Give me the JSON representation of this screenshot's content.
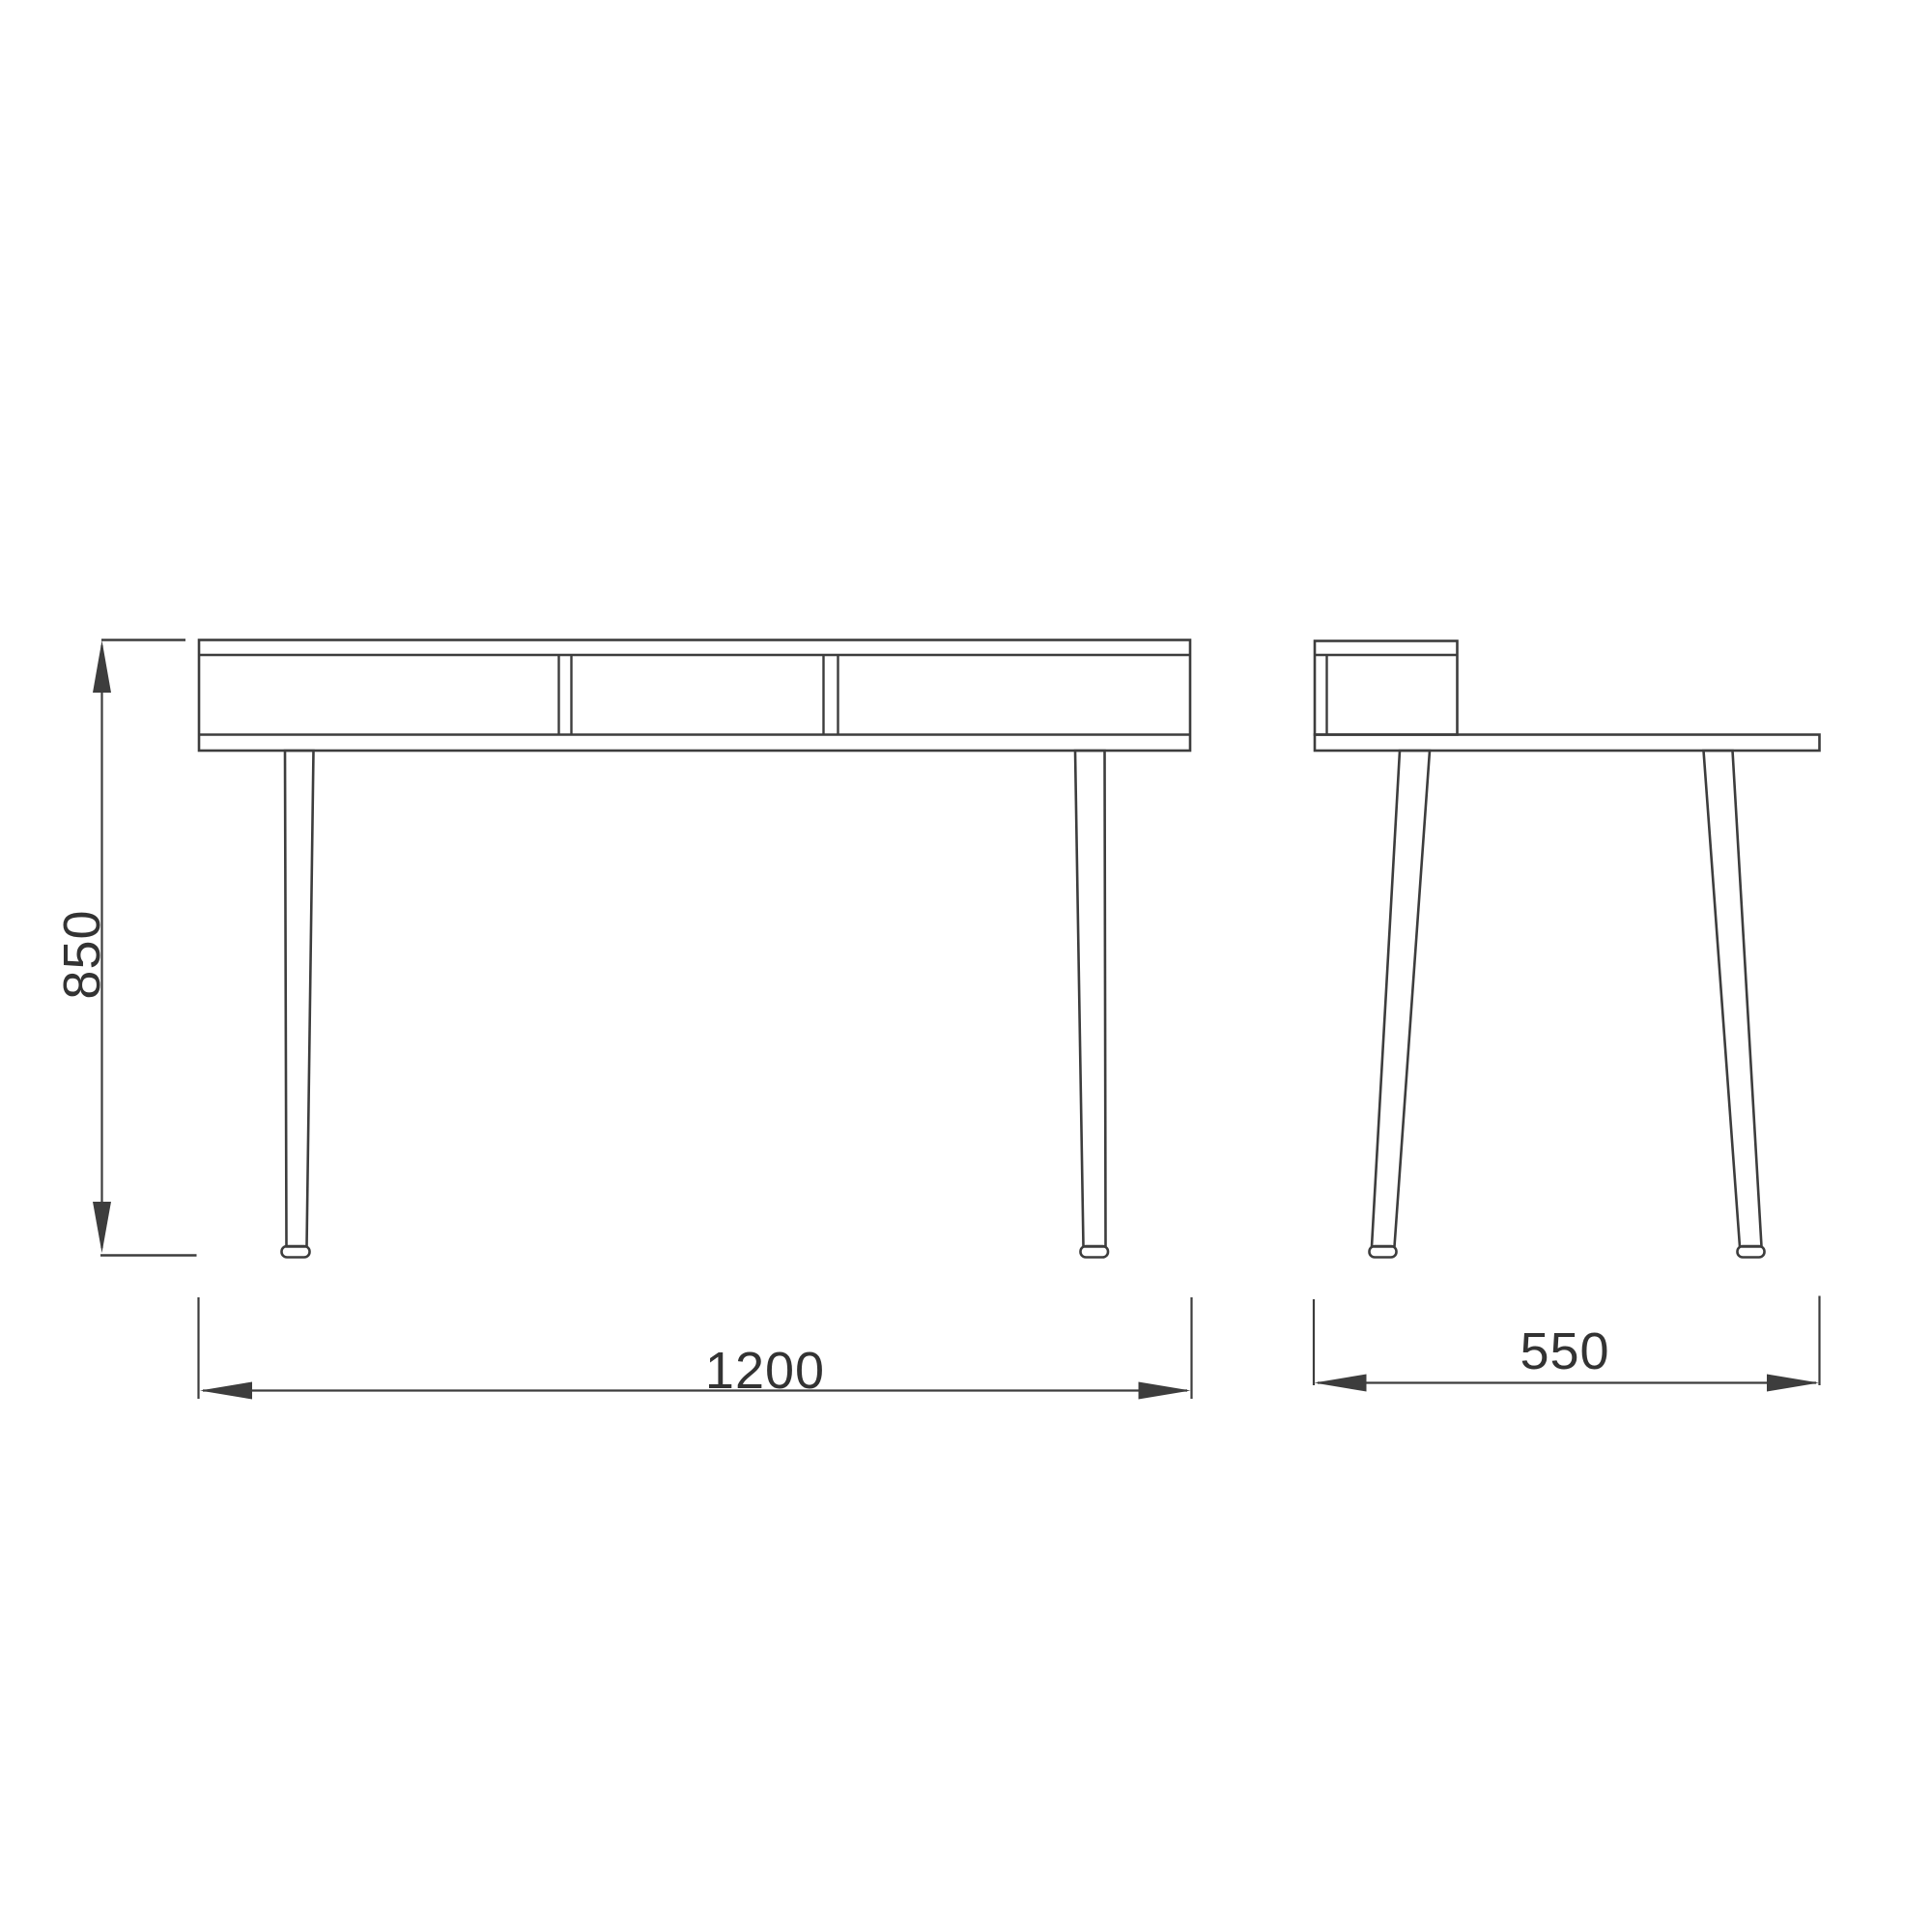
{
  "colors": {
    "background": "#ffffff",
    "line": "#3d3d3d",
    "text": "#333333"
  },
  "dimensions": {
    "height": {
      "label": "850",
      "orientation": "vertical"
    },
    "width": {
      "label": "1200",
      "orientation": "horizontal"
    },
    "depth": {
      "label": "550",
      "orientation": "horizontal"
    }
  },
  "views": {
    "front": {
      "compartments": 3,
      "legs": 2
    },
    "side": {
      "shelf_boxes": 1,
      "legs": 2
    }
  }
}
